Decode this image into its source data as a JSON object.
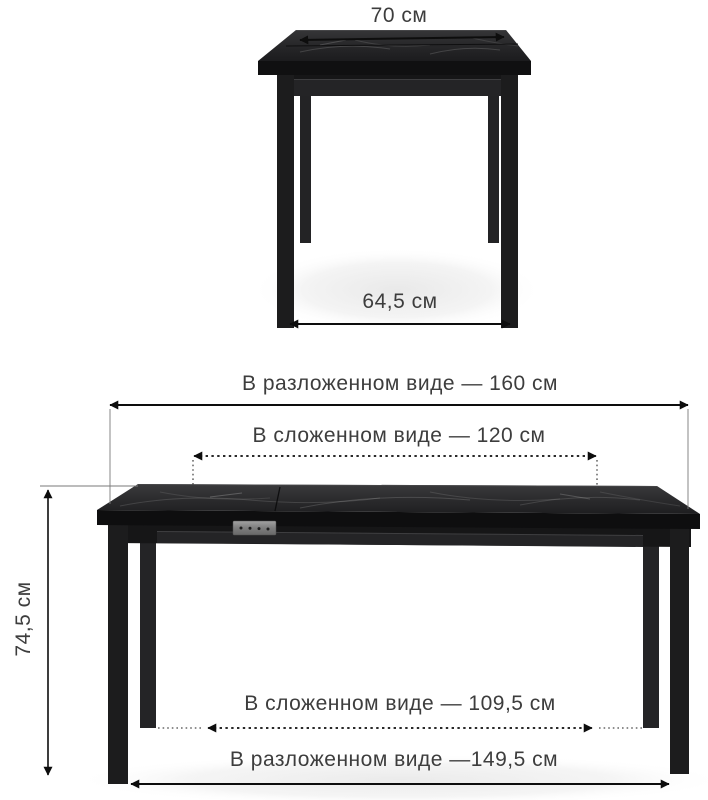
{
  "illustration": {
    "top_view": {
      "top_width_label": "70 см",
      "leg_span_label": "64,5 см"
    },
    "front_view": {
      "unfolded_width_label": "В разложенном виде — 160 см",
      "folded_width_label": "В сложенном виде — 120 см",
      "height_label": "74,5 см",
      "folded_leg_span_label": "В сложенном виде — 109,5 см",
      "unfolded_leg_span_label": "В разложенном виде —149,5 см"
    }
  },
  "colors": {
    "background": "#ffffff",
    "table_body": "#1d1d1f",
    "marble_vein": "#9f9f9f",
    "dimension_line": "#0d0d0d",
    "label_text": "#3d3d3d",
    "latch_metal": "#8a8a8a"
  }
}
